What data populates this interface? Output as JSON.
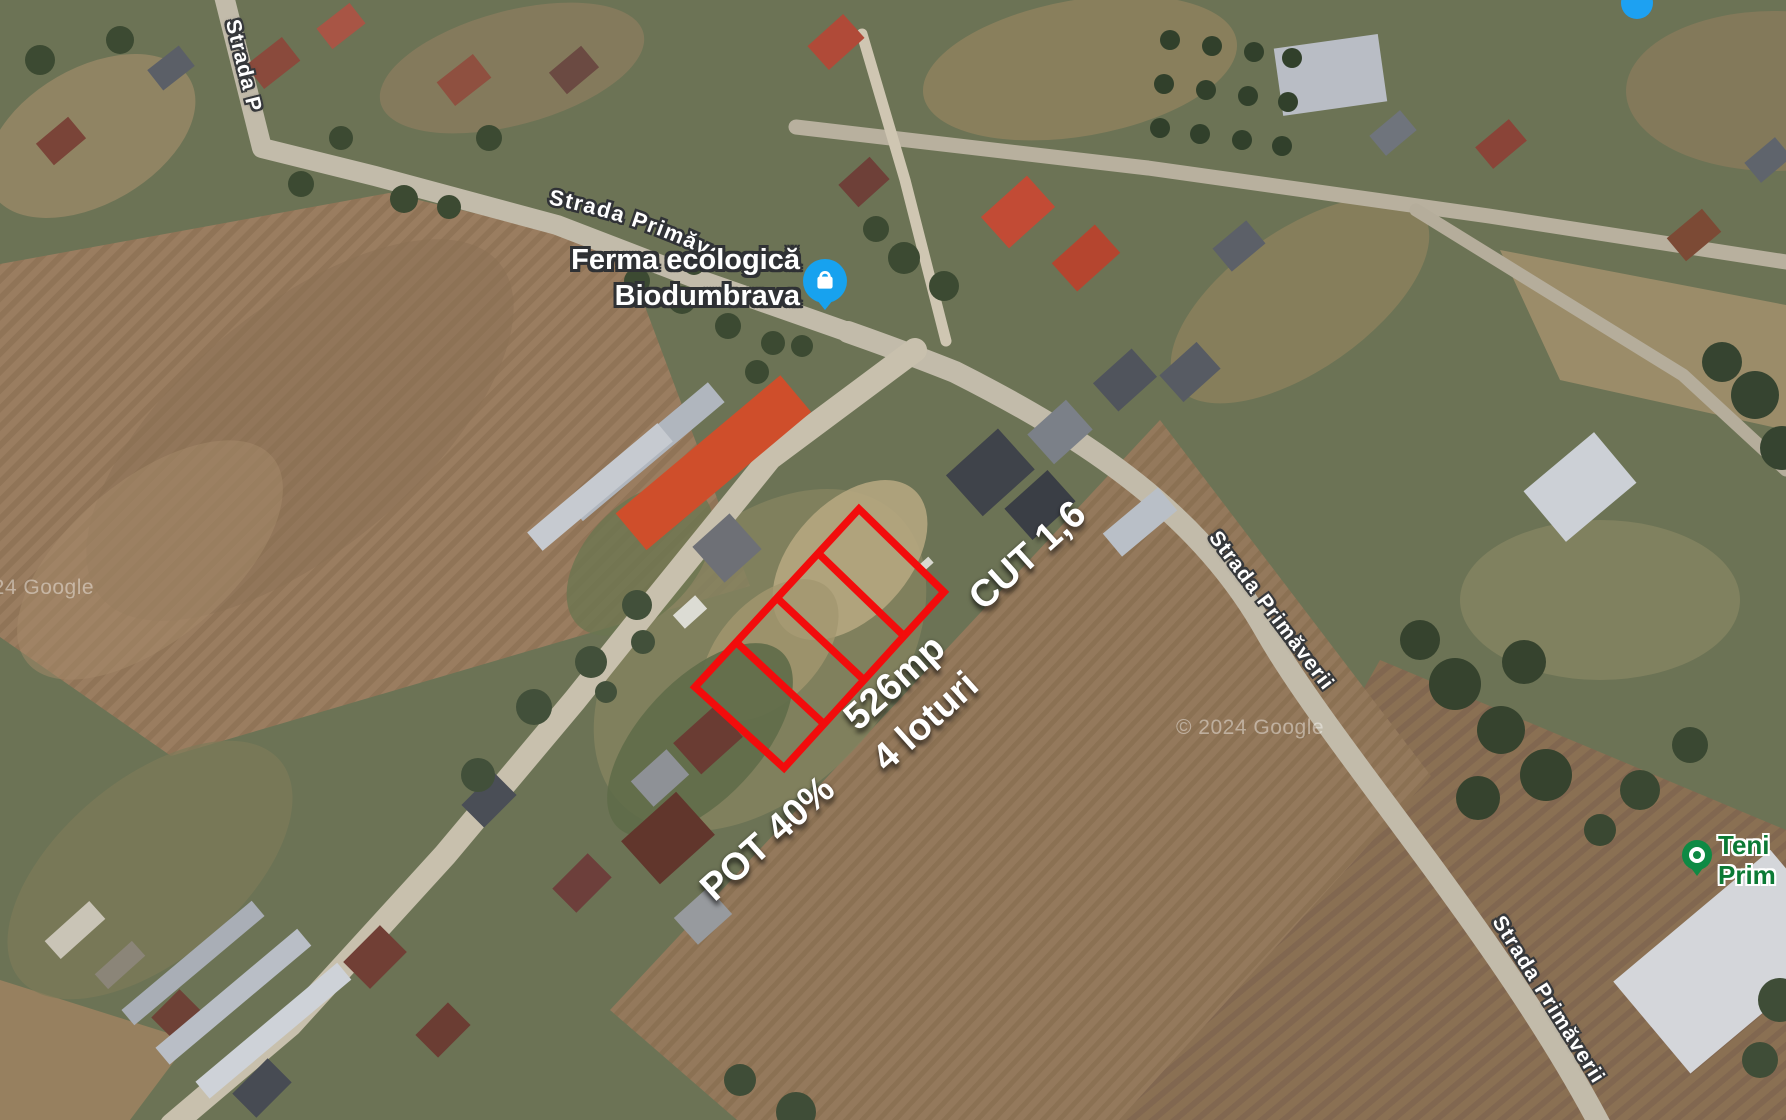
{
  "map": {
    "attribution": {
      "left": "© 2024 Google",
      "right": "© 2024 Google"
    },
    "streets": {
      "top_left": "Strada P",
      "top_curved": "Strada Primăve",
      "mid_right": "Strada Primăverii",
      "bottom_right": "Strada Primăverii"
    },
    "places": {
      "ferma": {
        "name_line1": "Ferma ecologică",
        "name_line2": "Biodumbrava",
        "pin_color": "#17a2ef",
        "icon": "shopping-bag-pin-icon"
      },
      "park": {
        "name_line1": "Teni",
        "name_line2": "Prim",
        "pin_color": "#0e8a44",
        "text_color": "#0c7a35",
        "icon": "park-pin-icon"
      },
      "extra_pin_color": "#1da1f2"
    },
    "listing": {
      "outline_color": "#f20c0c",
      "lot_count": 4,
      "annotations": {
        "pot": "POT 40%",
        "area": "526mp",
        "lots": "4 loturi",
        "cut": "CUT 1,6"
      }
    }
  }
}
